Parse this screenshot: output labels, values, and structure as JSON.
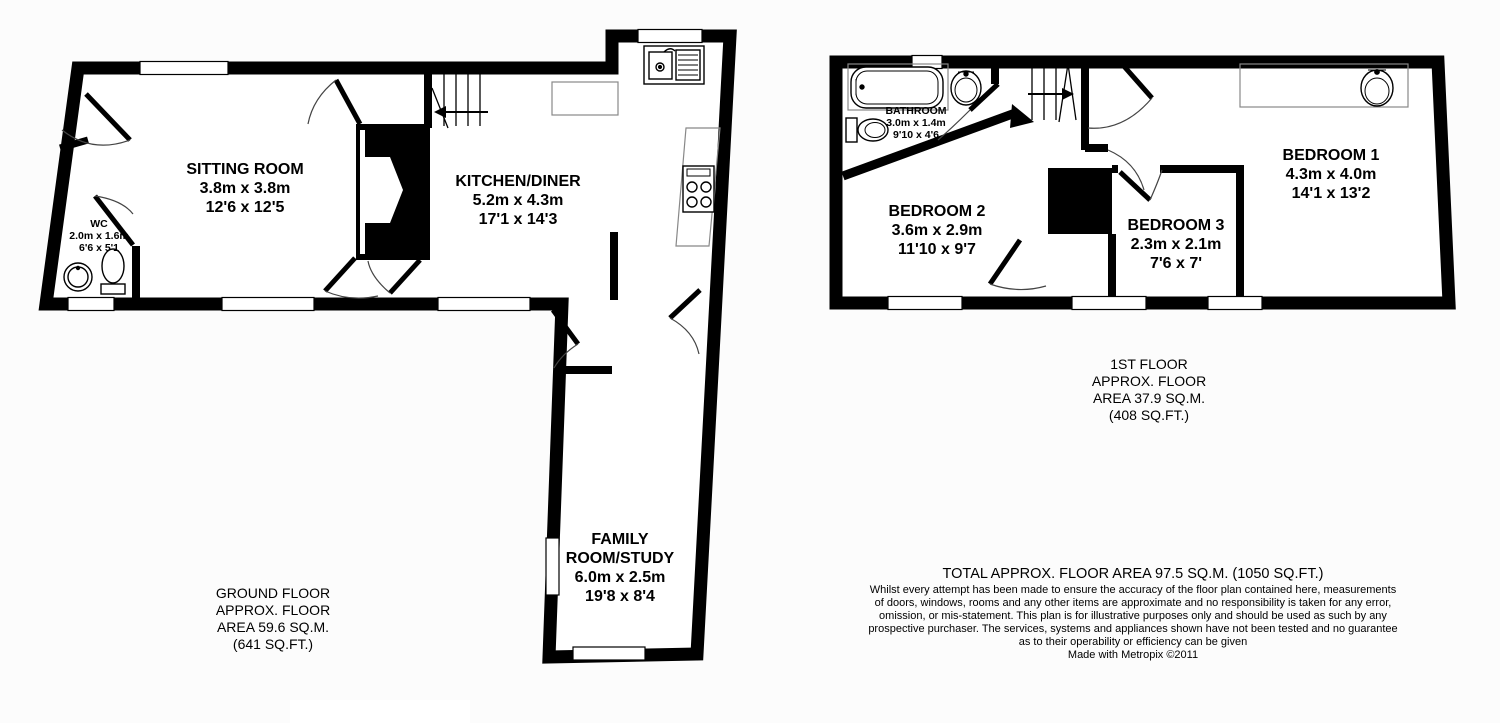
{
  "document_title": "Floor plan",
  "ground_floor": {
    "caption": "GROUND FLOOR\nAPPROX. FLOOR\nAREA 59.6 SQ.M.\n(641 SQ.FT.)",
    "rooms": {
      "sitting_room": {
        "name": "SITTING ROOM",
        "metric": "3.8m x 3.8m",
        "imperial": "12'6 x 12'5"
      },
      "kitchen_diner": {
        "name": "KITCHEN/DINER",
        "metric": "5.2m x 4.3m",
        "imperial": "17'1 x 14'3"
      },
      "wc": {
        "name": "WC",
        "metric": "2.0m x 1.6m",
        "imperial": "6'6 x 5'1"
      },
      "family_room": {
        "name": "FAMILY\nROOM/STUDY",
        "metric": "6.0m x 2.5m",
        "imperial": "19'8 x 8'4"
      }
    }
  },
  "first_floor": {
    "caption": "1ST FLOOR\nAPPROX. FLOOR\nAREA 37.9 SQ.M.\n(408 SQ.FT.)",
    "rooms": {
      "bathroom": {
        "name": "BATHROOM",
        "metric": "3.0m x 1.4m",
        "imperial": "9'10 x 4'6"
      },
      "bedroom_1": {
        "name": "BEDROOM 1",
        "metric": "4.3m x 4.0m",
        "imperial": "14'1 x 13'2"
      },
      "bedroom_2": {
        "name": "BEDROOM 2",
        "metric": "3.6m x 2.9m",
        "imperial": "11'10 x 9'7"
      },
      "bedroom_3": {
        "name": "BEDROOM 3",
        "metric": "2.3m x 2.1m",
        "imperial": "7'6 x 7'"
      }
    }
  },
  "footer": {
    "total": "TOTAL APPROX. FLOOR AREA 97.5 SQ.M. (1050 SQ.FT.)",
    "disclaimer": "Whilst every attempt has been made to ensure the accuracy of the floor plan contained here, measurements\nof doors, windows, rooms and any other items are approximate and no responsibility is taken for any error,\nomission, or mis-statement. This plan is for illustrative purposes only and should be used as such by any\nprospective purchaser. The services, systems and appliances shown have not been tested and no guarantee\nas to their operability or efficiency can be given",
    "credit": "Made with Metropix ©2011"
  },
  "colors": {
    "wall": "#000000",
    "floor": "#ffffff",
    "thin_line": "#777777"
  }
}
